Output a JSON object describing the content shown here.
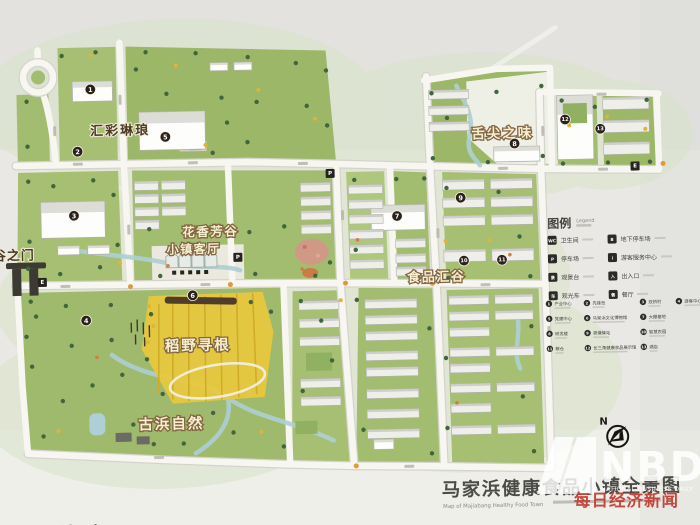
{
  "map": {
    "areas": {
      "huicai": "汇彩琳琅",
      "shejian": "舌尖之味",
      "huaxiang": "花香芳谷",
      "keting": "小镇客厅",
      "shipin": "食品汇谷",
      "daoye": "稻野寻根",
      "gubang": "古浜自然",
      "gate": "谷之门"
    },
    "markers": [
      {
        "n": "1"
      },
      {
        "n": "2"
      },
      {
        "n": "3"
      },
      {
        "n": "4"
      },
      {
        "n": "5"
      },
      {
        "n": "6"
      },
      {
        "n": "7"
      },
      {
        "n": "8"
      },
      {
        "n": "9"
      },
      {
        "n": "10"
      },
      {
        "n": "11"
      },
      {
        "n": "12"
      },
      {
        "n": "13"
      }
    ],
    "square_markers": [
      {
        "glyph": "P"
      },
      {
        "glyph": "E"
      },
      {
        "glyph": "E"
      },
      {
        "glyph": "P"
      }
    ]
  },
  "legend": {
    "title": "图例",
    "subtitle": "Legend",
    "facilities": [
      {
        "glyph": "WC",
        "label": "卫生间"
      },
      {
        "glyph": "P",
        "label": "停车场"
      },
      {
        "glyph": "景",
        "label": "观景台"
      },
      {
        "glyph": "车",
        "label": "观光车"
      },
      {
        "glyph": "B",
        "label": "地下停车场"
      },
      {
        "glyph": "i",
        "label": "游客服务中心"
      },
      {
        "glyph": "入",
        "label": "出入口"
      },
      {
        "glyph": "餐",
        "label": "餐厅"
      }
    ],
    "points": [
      {
        "n": "1",
        "label": "产业中心"
      },
      {
        "n": "2",
        "label": "先锋岛"
      },
      {
        "n": "3",
        "label": "双桥村"
      },
      {
        "n": "4",
        "label": "游客中心"
      },
      {
        "n": "5",
        "label": "党建中心"
      },
      {
        "n": "6",
        "label": "马家浜文化博物馆"
      },
      {
        "n": "7",
        "label": "大棚基地"
      },
      {
        "n": "8",
        "label": "研发楼"
      },
      {
        "n": "9",
        "label": "荷塘驿站"
      },
      {
        "n": "10",
        "label": "智慧农园"
      },
      {
        "n": "11",
        "label": "粮仓"
      },
      {
        "n": "12",
        "label": "长三角健康食品展示馆"
      },
      {
        "n": "13",
        "label": "酒店"
      }
    ]
  },
  "compass": {
    "label": "N"
  },
  "title_block": {
    "title": "马家浜健康食品小镇全景图",
    "subtitle": "Map of Majiabang Healthy Food Town"
  },
  "watermark": {
    "brand": "NBD",
    "brand_sub": "NATIONAL BUSINESS DAILY",
    "brand_cn": "每日经济新闻"
  },
  "bottom_left_partial": "漫游线路"
}
